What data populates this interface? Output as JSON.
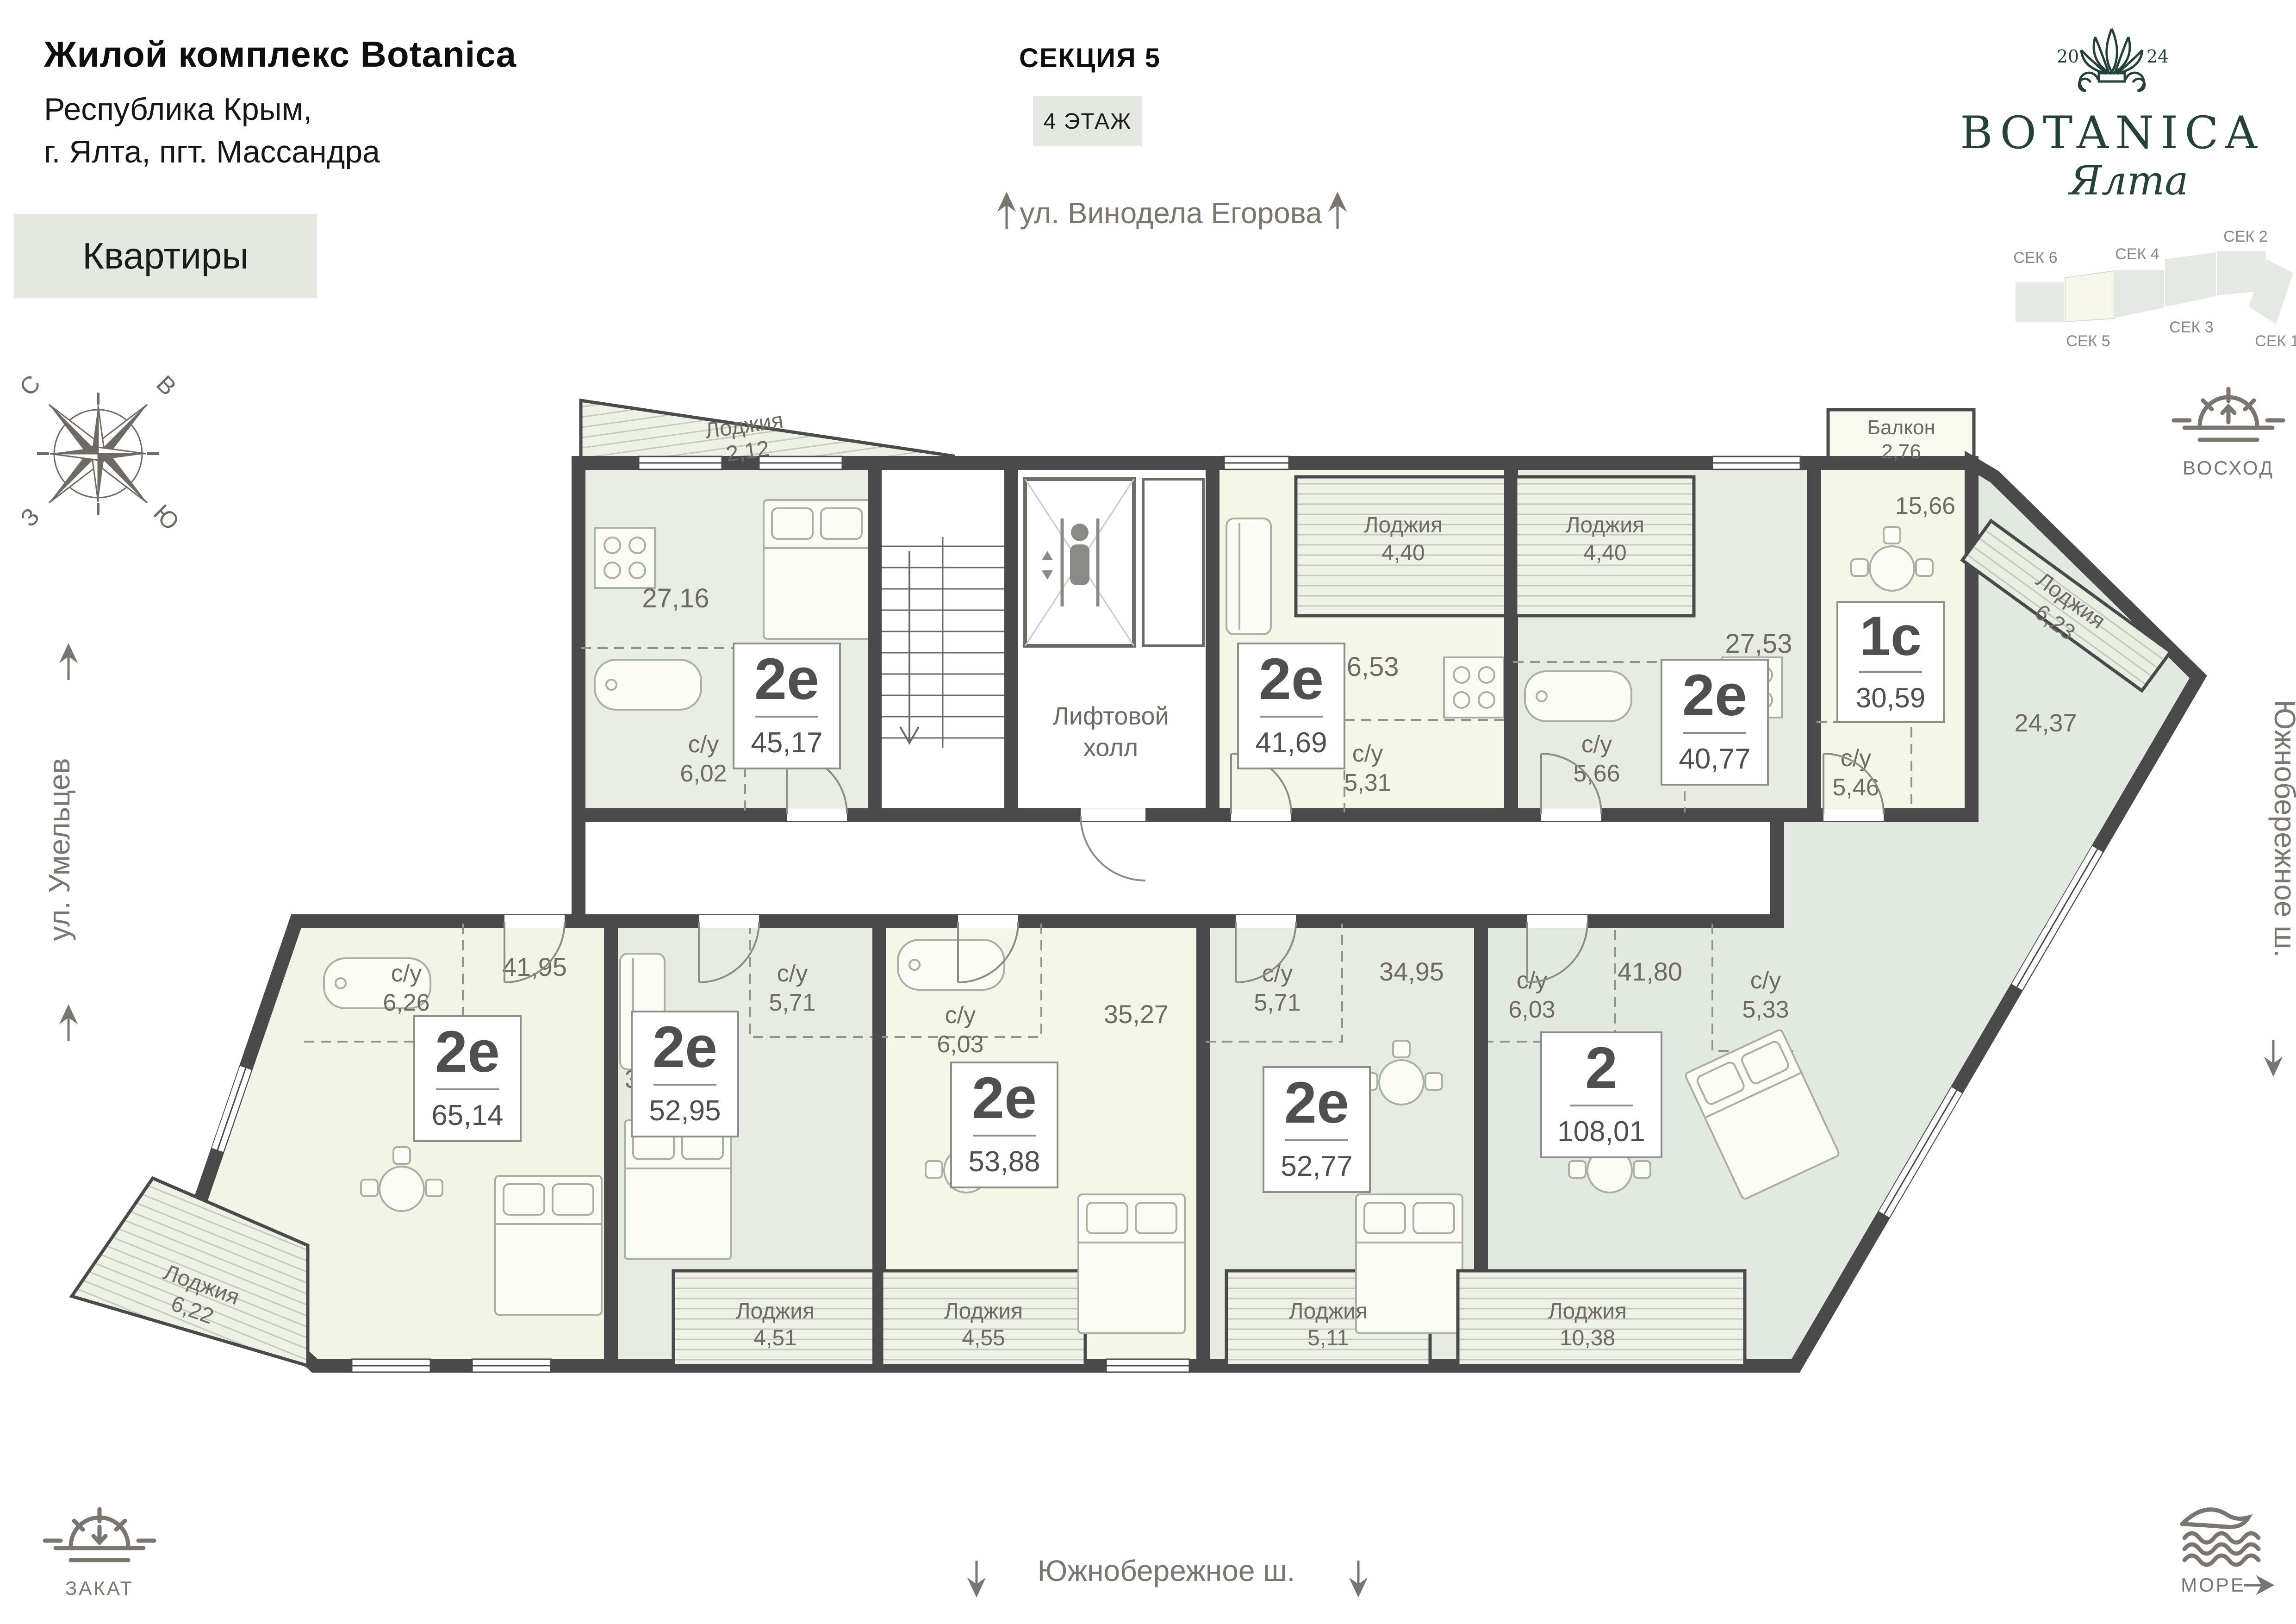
{
  "header": {
    "complex_title": "Жилой комплекс Botanica",
    "address_line1": "Республика Крым,",
    "address_line2": "г. Ялта, пгт. Массандра",
    "apartments_badge": "Квартиры",
    "section_label": "СЕКЦИЯ 5",
    "floor_label": "4 ЭТАЖ"
  },
  "logo": {
    "year_left": "20",
    "year_right": "24",
    "brand": "BOTANICA",
    "city": "Ялта"
  },
  "section_map": {
    "top": [
      "СЕК 6",
      "СЕК 4",
      "СЕК 2"
    ],
    "bottom": [
      "СЕК 5",
      "СЕК 3",
      "СЕК 1"
    ]
  },
  "streets": {
    "top": "ул. Винодела Егорова",
    "left": "ул. Умельцев",
    "right": "Южнобережное ш.",
    "bottom": "Южнобережное ш."
  },
  "compass": {
    "n": "С",
    "e": "В",
    "w": "З",
    "s": "Ю"
  },
  "corners": {
    "sunrise": "ВОСХОД",
    "sunset": "ЗАКАТ",
    "sea": "МОРЕ"
  },
  "plan": {
    "lift_hall_line1": "Лифтовой",
    "lift_hall_line2": "холл"
  },
  "apartments": [
    {
      "type": "2е",
      "area": "45,17",
      "room": "27,16",
      "wc_label": "с/у",
      "wc": "6,02",
      "loggia_label": "Лоджия",
      "loggia": "2,12"
    },
    {
      "type": "2е",
      "area": "41,69",
      "room": "26,53",
      "wc_label": "с/у",
      "wc": "5,31",
      "loggia_label": "Лоджия",
      "loggia": "4,40"
    },
    {
      "type": "2е",
      "area": "40,77",
      "room": "27,53",
      "wc_label": "с/у",
      "wc": "5,66",
      "loggia_label": "Лоджия",
      "loggia": "4,40"
    },
    {
      "type": "1с",
      "area": "30,59",
      "room": "15,66",
      "wc_label": "с/у",
      "wc": "5,46",
      "balcony_label": "Балкон",
      "balcony": "2,76"
    },
    {
      "type": "2е",
      "area": "65,14",
      "room": "41,95",
      "wc_label": "с/у",
      "wc": "6,26",
      "loggia_label": "Лоджия",
      "loggia": "6,22"
    },
    {
      "type": "2е",
      "area": "52,95",
      "room": "34,95",
      "wc_label": "с/у",
      "wc": "5,71",
      "loggia_label": "Лоджия",
      "loggia": "4,51"
    },
    {
      "type": "2е",
      "area": "53,88",
      "room": "35,27",
      "wc_label": "с/у",
      "wc": "6,03",
      "loggia_label": "Лоджия",
      "loggia": "4,55"
    },
    {
      "type": "2е",
      "area": "52,77",
      "room": "34,95",
      "wc_label": "с/у",
      "wc": "5,71",
      "loggia_label": "Лоджия",
      "loggia": "5,11"
    },
    {
      "type": "2",
      "area": "108,01",
      "room": "41,80",
      "room2": "24,37",
      "wc_label": "с/у",
      "wc": "6,03",
      "wc2_label": "с/у",
      "wc2": "5,33",
      "loggia_label": "Лоджия",
      "loggia": "10,38",
      "loggia2_label": "Лоджия",
      "loggia2": "6,23"
    }
  ]
}
